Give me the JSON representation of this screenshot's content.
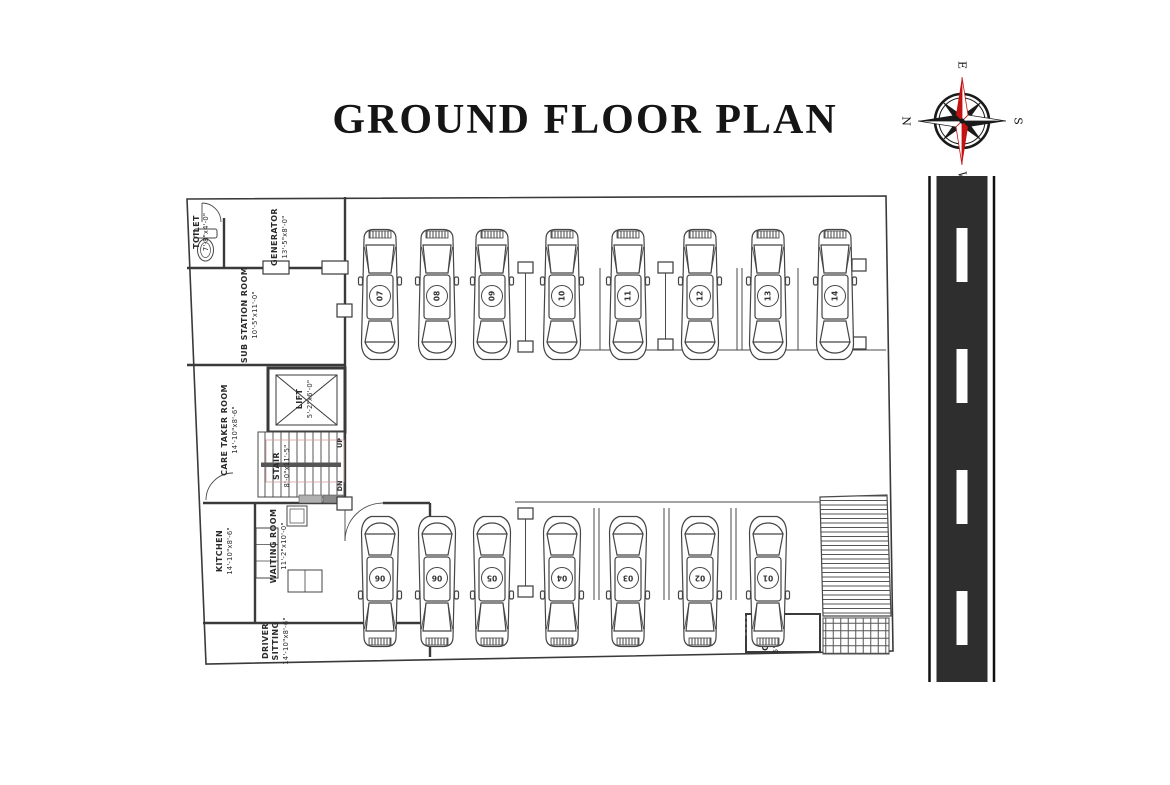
{
  "title": "GROUND FLOOR PLAN",
  "compass": {
    "n": "N",
    "e": "E",
    "s": "S",
    "w": "W",
    "needle_red": "#c41111",
    "needle_black": "#1a1a1a"
  },
  "rooms": {
    "toilet": {
      "name": "TOILET",
      "dims": "7'-8\"x4'-0\""
    },
    "generator": {
      "name": "GENERATOR",
      "dims": "13'-5\"x8'-0\""
    },
    "substation": {
      "name": "SUB STATION ROOM",
      "dims": "10'-5\"x11'-0\""
    },
    "caretaker": {
      "name": "CARE TAKER ROOM",
      "dims": "14'-10\"x8'-6\""
    },
    "lift": {
      "name": "LIFT",
      "dims": "5'-2\"x6'-0\""
    },
    "stair": {
      "name": "STAIR",
      "dims": "8'-0\"x11'-5\"",
      "up": "UP",
      "dn": "DN"
    },
    "waiting": {
      "name": "WAITING ROOM",
      "dims": "11'-2\"x10'-0\""
    },
    "kitchen": {
      "name": "KITCHEN",
      "dims": "14'-10\"x8'-6\""
    },
    "driver": {
      "name1": "DRIVER",
      "name2": "SITTING",
      "dims": "14'-10\"x8'-6\""
    },
    "guard": {
      "name": "GUARD",
      "dims": "5'-5\"x8'-1\""
    }
  },
  "parking": {
    "top_row": [
      "07",
      "08",
      "09",
      "10",
      "11",
      "12",
      "13",
      "14"
    ],
    "bottom_row": [
      "06",
      "06",
      "05",
      "04",
      "03",
      "02",
      "01"
    ]
  },
  "colors": {
    "road": "#2e2e2e",
    "line": "#3a3a3a",
    "handrail": "#555555"
  }
}
